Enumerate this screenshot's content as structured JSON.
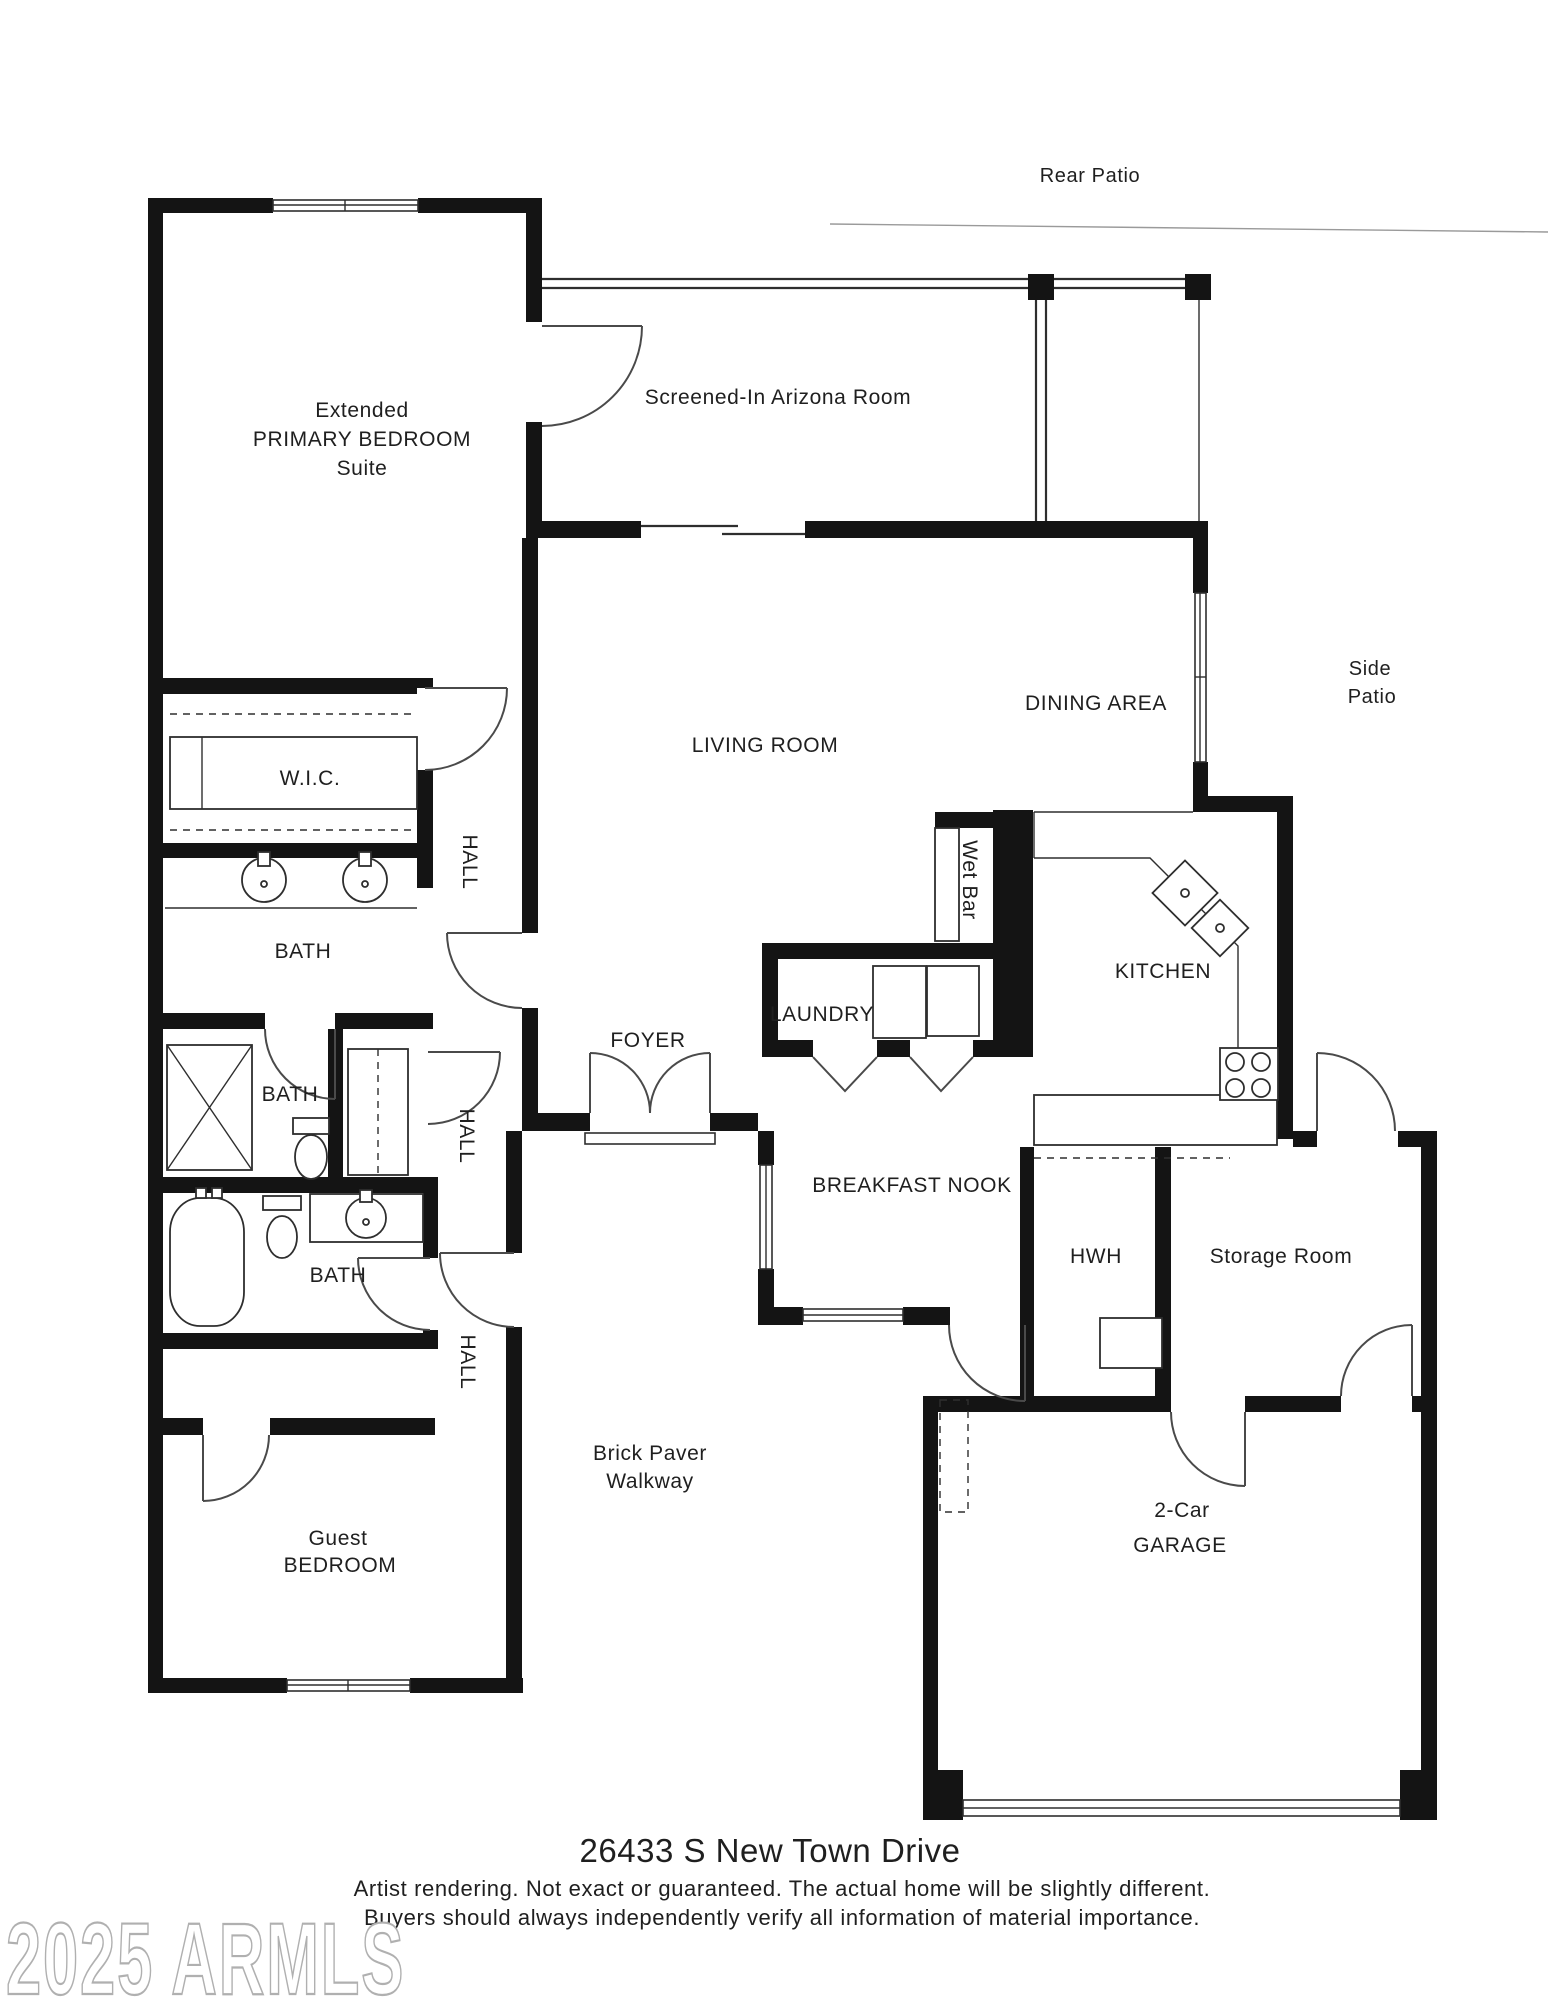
{
  "colors": {
    "wall": "#141414",
    "line": "#2e2e2e",
    "door": "#4a4a4a",
    "text": "#1f1f1f",
    "watermark": "#b0b0b0"
  },
  "rooms": {
    "rear_patio": "Rear Patio",
    "primary_bedroom": [
      "Extended",
      "PRIMARY BEDROOM",
      "Suite"
    ],
    "arizona_room": "Screened-In Arizona Room",
    "side_patio": [
      "Side",
      "Patio"
    ],
    "dining_area": "DINING AREA",
    "living_room": "LIVING ROOM",
    "wic": "W.I.C.",
    "hall_upper": "HALL",
    "hall_middle": "HALL",
    "hall_lower": "HALL",
    "bath_primary": "BATH",
    "bath_middle": "BATH",
    "bath_lower": "BATH",
    "wet_bar": "Wet Bar",
    "kitchen": "KITCHEN",
    "laundry": "LAUNDRY",
    "foyer": "FOYER",
    "breakfast_nook": "BREAKFAST NOOK",
    "hwh": "HWH",
    "storage_room": "Storage Room",
    "walkway": [
      "Brick Paver",
      "Walkway"
    ],
    "guest_bedroom": [
      "Guest",
      "BEDROOM"
    ],
    "garage": [
      "2-Car",
      "GARAGE"
    ]
  },
  "footer": {
    "address": "26433 S New Town Drive",
    "disclaimer_line1": "Artist rendering. Not exact or guaranteed. The actual home will be slightly different.",
    "disclaimer_line2": "Buyers should always independently verify all information of material importance.",
    "watermark": "2025 ARMLS"
  }
}
